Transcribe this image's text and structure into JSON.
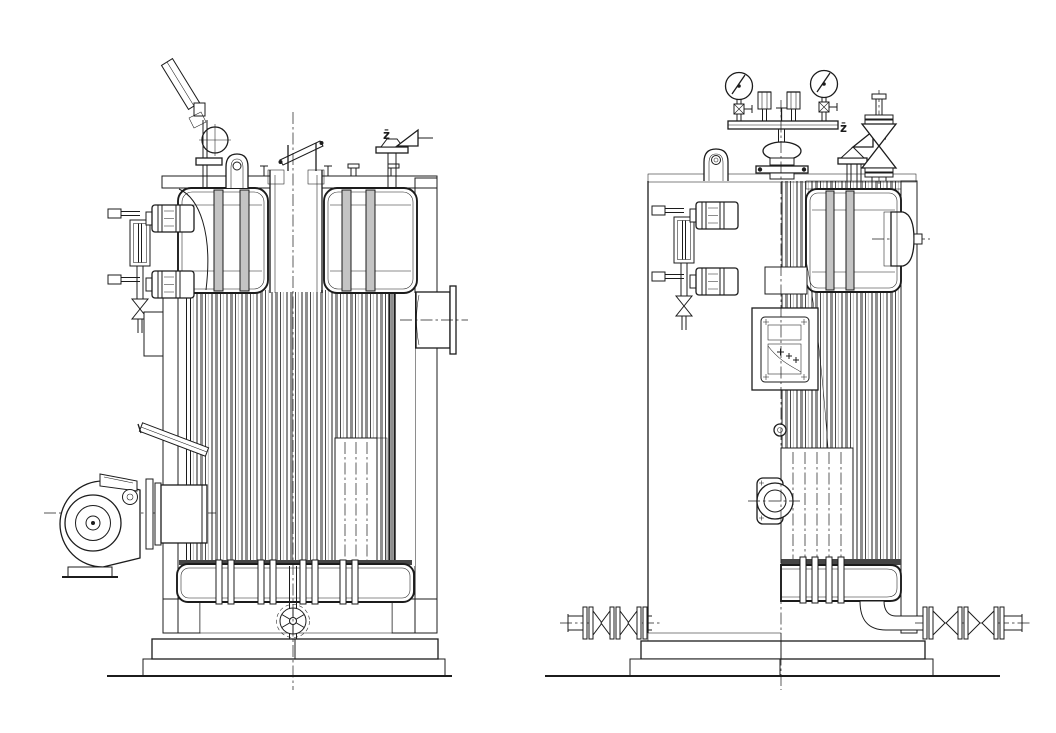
{
  "page": {
    "background": "#ffffff",
    "ink": "#1c1c1c",
    "tube_gray": "#8f8f8f"
  },
  "drawing": {
    "subject": "vertical-steam-boiler-two-elevation-views",
    "views": {
      "left": {
        "name": "side-elevation-section",
        "safety_valve_label": "z̄",
        "components": [
          "thermometer",
          "gauge-siphon-ring",
          "lifting-lug",
          "chimney-cap",
          "safety-valve",
          "water-level-gauge",
          "drain-cock",
          "burner-blower",
          "burner-barrel",
          "air-pipe",
          "flue-gas-outlet",
          "tube-bank",
          "upper-drum",
          "bottom-header",
          "ash-door-wheel",
          "brick-setting",
          "concrete-foundation"
        ]
      },
      "right": {
        "name": "front-elevation-half-section",
        "safety_valve_label": "z̄",
        "components": [
          "pressure-gauge-left",
          "pressure-gauge-right",
          "instrument-manifold",
          "probe-block-left",
          "probe-block-right",
          "main-steam-valve",
          "safety-valve",
          "stop-valve",
          "lifting-lug",
          "water-level-gauge",
          "nameplate",
          "control-panel",
          "sight-glass",
          "burner-mount",
          "manhole-cover",
          "steam-header",
          "tube-bank",
          "bottom-header",
          "blowdown-valves-left",
          "blowdown-valves-right",
          "brick-setting",
          "concrete-foundation"
        ]
      }
    }
  }
}
